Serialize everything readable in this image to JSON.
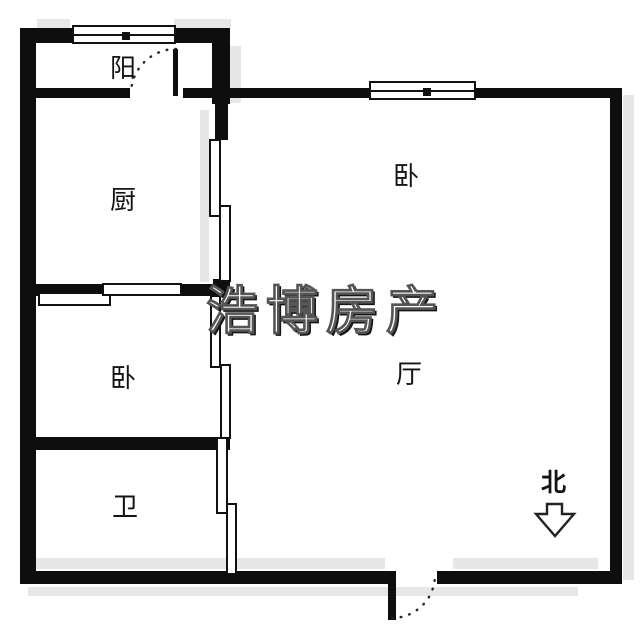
{
  "plan": {
    "rooms": {
      "balcony": {
        "label": "阳"
      },
      "kitchen": {
        "label": "厨"
      },
      "bedroom_top": {
        "label": "卧"
      },
      "bedroom_left": {
        "label": "卧"
      },
      "living_room": {
        "label": "厅"
      },
      "bathroom": {
        "label": "卫"
      }
    },
    "compass": {
      "label": "北",
      "icon": "north-arrow-down"
    },
    "watermark": {
      "text": "浩博房产"
    },
    "colors": {
      "wall": "#0e0e0e",
      "background": "#ffffff",
      "shadow": "#e7e7e7",
      "watermark_fill": "#ffffff",
      "watermark_outline": "#161616"
    }
  }
}
